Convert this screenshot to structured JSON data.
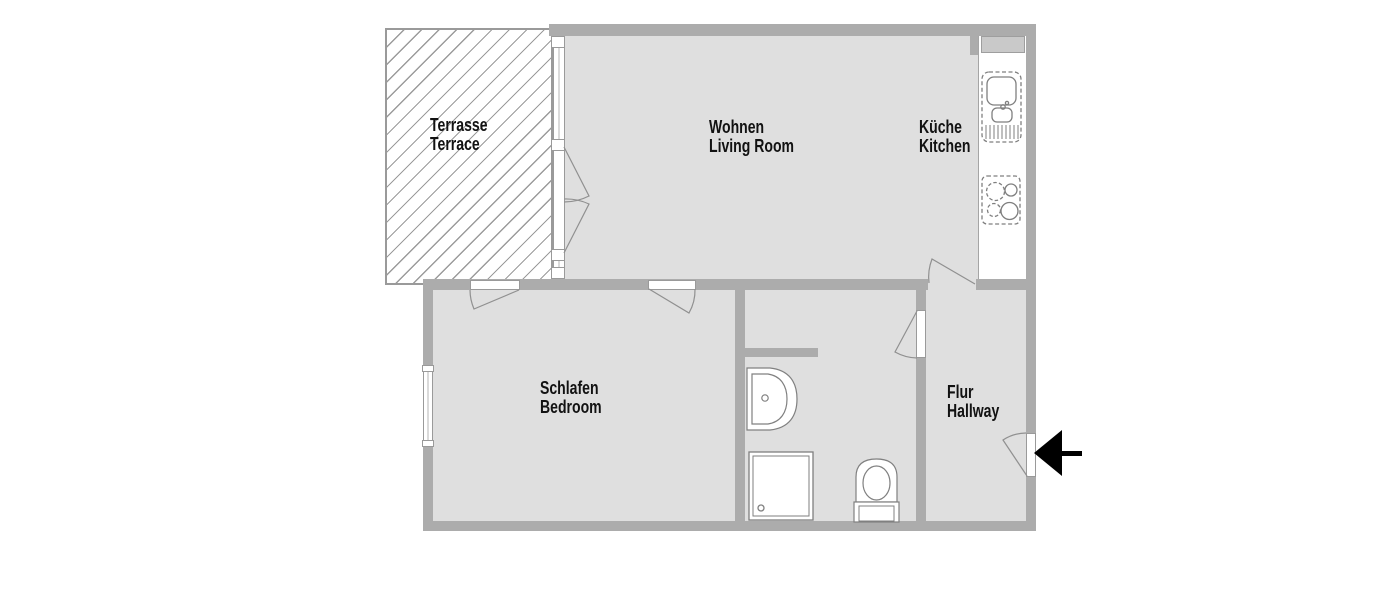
{
  "plan": {
    "title": "apartment-floor-plan",
    "rooms": {
      "terrace": {
        "label_de": "Terrasse",
        "label_en": "Terrace"
      },
      "living_room": {
        "label_de": "Wohnen",
        "label_en": "Living Room"
      },
      "kitchen": {
        "label_de": "Küche",
        "label_en": "Kitchen"
      },
      "bedroom": {
        "label_de": "Schlafen",
        "label_en": "Bedroom"
      },
      "hallway": {
        "label_de": "Flur",
        "label_en": "Hallway"
      }
    },
    "fixtures": [
      "kitchen-sink",
      "stove",
      "wash-basin",
      "shower",
      "toilet"
    ],
    "icons": {
      "entrance_arrow": "arrow-left"
    },
    "colors": {
      "wall": "#acacac",
      "floor": "#dfdfdf",
      "fixture_outline": "#7f7f7f",
      "door_swing": "#909090",
      "hatch": "#9b9b9b",
      "label": "#121212",
      "arrow": "#000000",
      "background": "#ffffff"
    }
  }
}
